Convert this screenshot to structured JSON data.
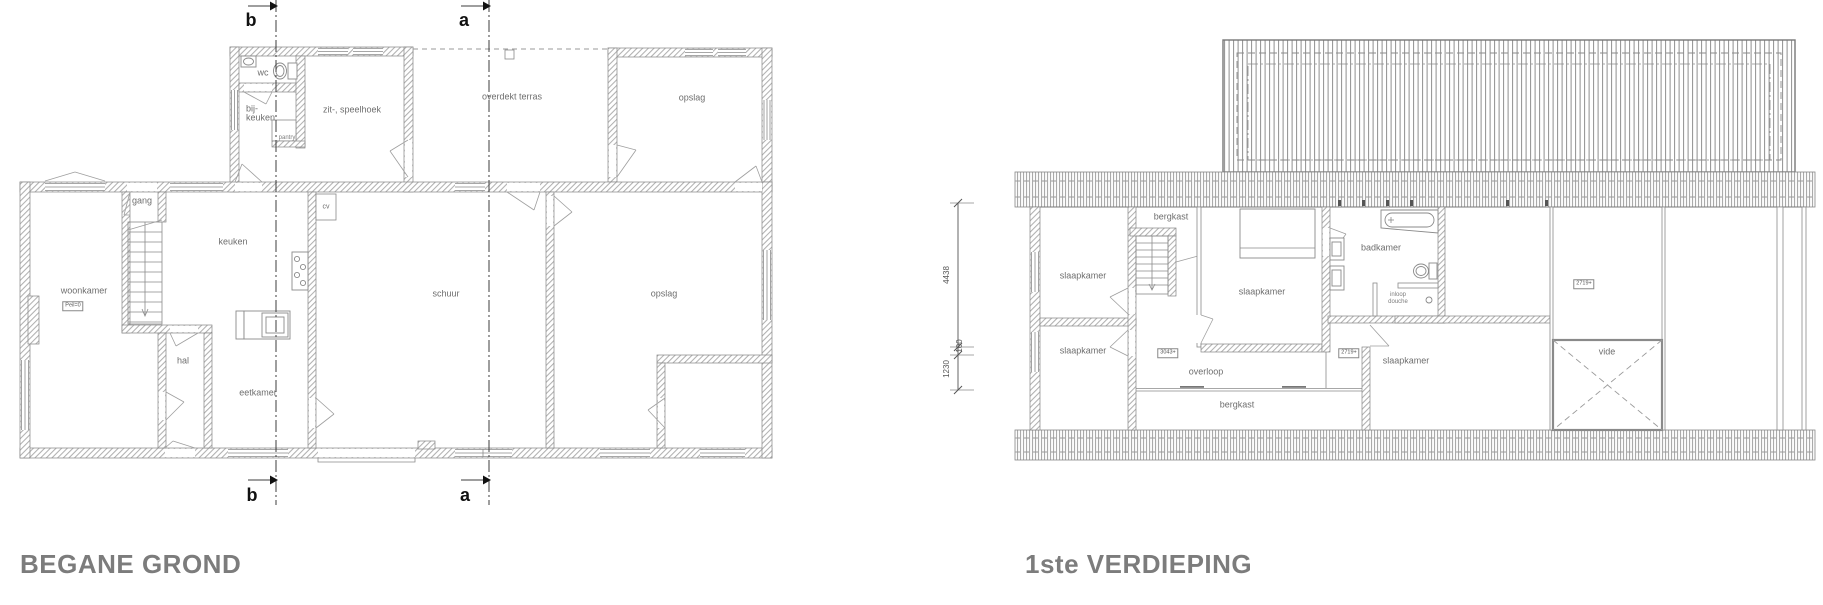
{
  "ground_floor": {
    "title": "BEGANE GROND",
    "section_b": "b",
    "section_a": "a",
    "rooms": {
      "wc": "wc",
      "bijkeuken_line1": "bij-",
      "bijkeuken_line2": "keuken",
      "pantry": "pantry",
      "zit_speelhoek": "zit-, speelhoek",
      "overdekt_terras": "overdekt terras",
      "opslag_top": "opslag",
      "gang": "gang",
      "cv": "cv",
      "keuken": "keuken",
      "woonkamer": "woonkamer",
      "hal": "hal",
      "eetkamer": "eetkamer",
      "schuur": "schuur",
      "opslag_main": "opslag"
    },
    "levels": {
      "peil": "Peil=0"
    }
  },
  "first_floor": {
    "title": "1ste VERDIEPING",
    "rooms": {
      "slaapkamer_tl": "slaapkamer",
      "slaapkamer_bl": "slaapkamer",
      "bergkast_top": "bergkast",
      "slaapkamer_mid": "slaapkamer",
      "badkamer": "badkamer",
      "inloop_line1": "inloop",
      "inloop_line2": "douche",
      "slaapkamer_br": "slaapkamer",
      "overloop": "overloop",
      "bergkast_bottom": "bergkast",
      "vide": "vide"
    },
    "levels": {
      "overloop_level": "3043+",
      "slaapkamer_br_level": "2719+",
      "attic_level": "2719+"
    },
    "dimensions": {
      "d_4438": "4438",
      "d_100": "100",
      "d_1230": "1230"
    }
  },
  "colors": {
    "title_gray": "#7c7c7c",
    "line_gray": "#868686",
    "label_gray": "#6e6e6e"
  }
}
